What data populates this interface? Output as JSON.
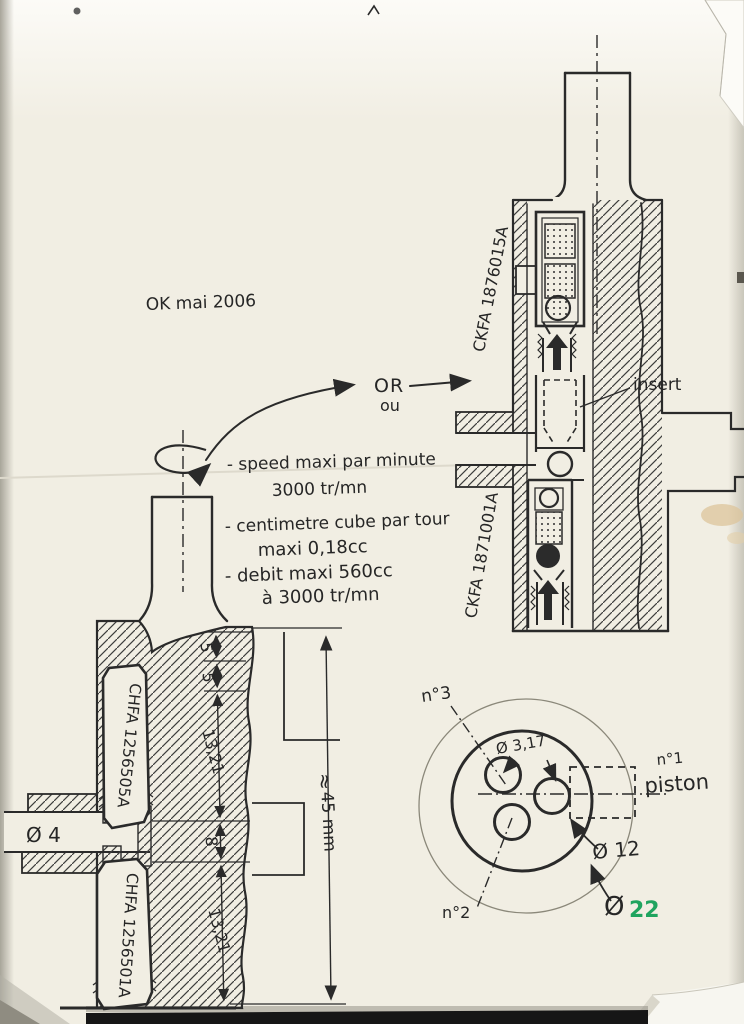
{
  "note": {
    "date_mark": "OK mai 2006"
  },
  "connector": {
    "or": "OR",
    "ou": "ou"
  },
  "specs": {
    "l1": "- speed maxi par minute",
    "l2": "3000 tr/mn",
    "l3": "- centimetre cube par tour",
    "l4": "maxi 0,18cc",
    "l5": "- debit maxi 560cc",
    "l6": "à 3000 tr/mn"
  },
  "left_drawing": {
    "cartridge_upper": "CHFA 1256505A",
    "cartridge_lower": "CHFA 1256501A",
    "port_dim": "Ø 4",
    "dim_5a": "5",
    "dim_5b": "5",
    "dim_1321a": "13,21",
    "dim_8": "8",
    "dim_1321b": "13,21",
    "approx": "≈",
    "overall": "45 mm"
  },
  "right_drawing": {
    "cartridge_upper": "CKFA 1876015A",
    "cartridge_lower": "CKFA 1871001A",
    "insert": "insert"
  },
  "section": {
    "n3": "n°3",
    "n2": "n°2",
    "n1": "n°1",
    "piston": "piston",
    "hole_dim": "Ø 3,17",
    "bore_dim": "Ø 12",
    "outer_dim_symbol": "Ø",
    "outer_dim_value": "22"
  },
  "colors": {
    "ink": "#2a2a2a",
    "green": "#1fa45f",
    "paper": "#f1eee3"
  }
}
